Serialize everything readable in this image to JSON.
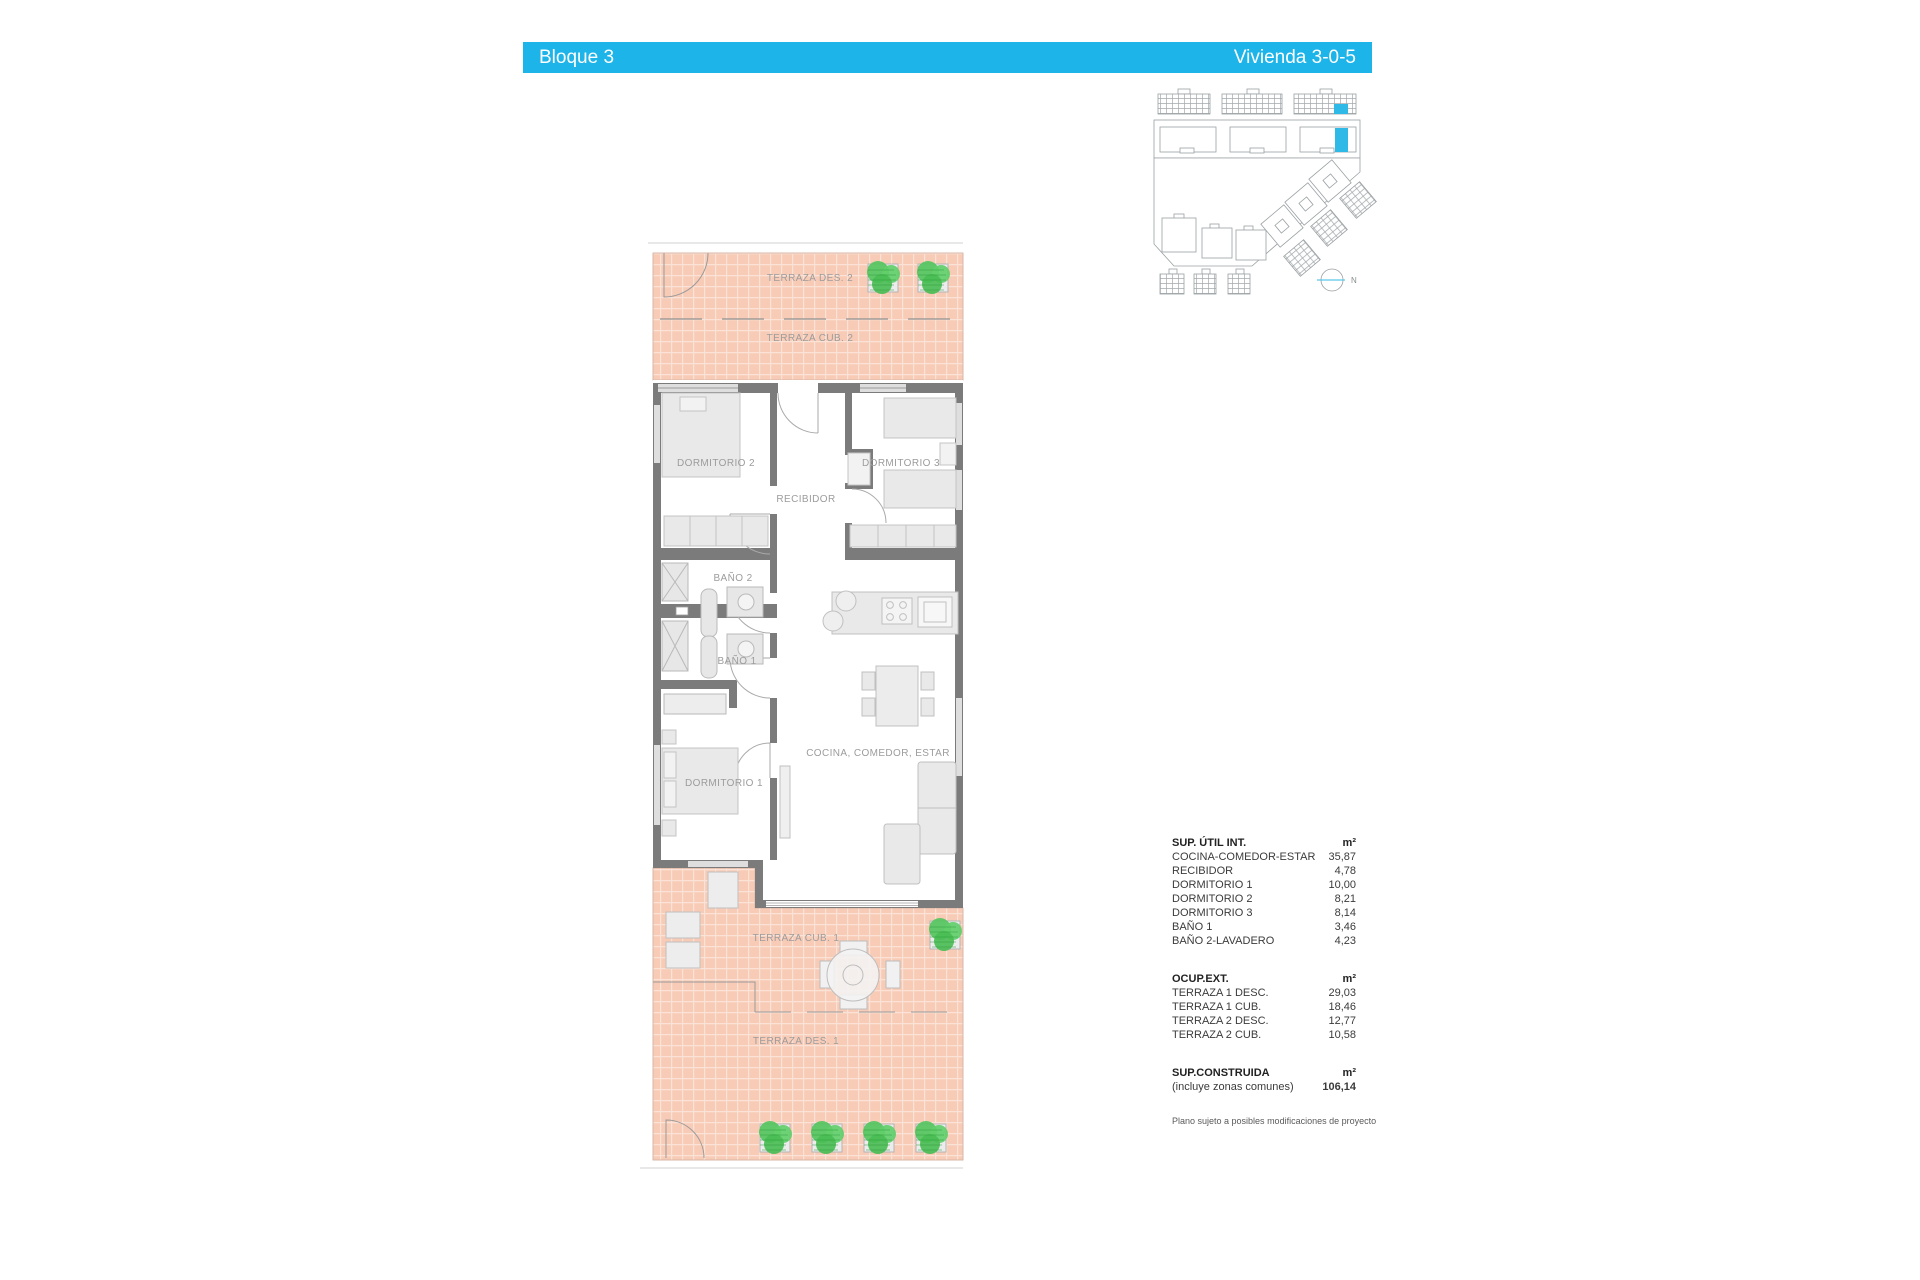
{
  "header": {
    "block_title": "Bloque 3",
    "unit_title": "Vivienda 3-0-5",
    "accent_color": "#1cb4e9"
  },
  "site_plan": {
    "north_label": "N",
    "highlight_color": "#2fb9e6"
  },
  "floor_plan": {
    "labels": {
      "terraza_des_2": "TERRAZA DES. 2",
      "terraza_cub_2": "TERRAZA CUB. 2",
      "dormitorio_2": "DORMITORIO 2",
      "dormitorio_3": "DORMITORIO 3",
      "recibidor": "RECIBIDOR",
      "bano_2": "BAÑO 2",
      "bano_1": "BAÑO 1",
      "dormitorio_1": "DORMITORIO 1",
      "cocina": "COCINA, COMEDOR, ESTAR",
      "terraza_cub_1": "TERRAZA CUB. 1",
      "terraza_des_1": "TERRAZA DES. 1"
    },
    "colors": {
      "terrace_fill": "#f8cbb7",
      "wall": "#7b7b7b",
      "furniture": "#e9e9e9",
      "plant_green": "#55c45e"
    }
  },
  "tables": {
    "util": {
      "title": "SUP. ÚTIL INT.",
      "unit": "m²",
      "rows": [
        {
          "label": "COCINA-COMEDOR-ESTAR",
          "value": "35,87"
        },
        {
          "label": "RECIBIDOR",
          "value": "4,78"
        },
        {
          "label": "DORMITORIO 1",
          "value": "10,00"
        },
        {
          "label": "DORMITORIO 2",
          "value": "8,21"
        },
        {
          "label": "DORMITORIO 3",
          "value": "8,14"
        },
        {
          "label": "BAÑO 1",
          "value": "3,46"
        },
        {
          "label": "BAÑO 2-LAVADERO",
          "value": "4,23"
        }
      ]
    },
    "ext": {
      "title": "OCUP.EXT.",
      "unit": "m²",
      "rows": [
        {
          "label": "TERRAZA 1 DESC.",
          "value": "29,03"
        },
        {
          "label": "TERRAZA 1 CUB.",
          "value": "18,46"
        },
        {
          "label": "TERRAZA 2 DESC.",
          "value": "12,77"
        },
        {
          "label": "TERRAZA 2 CUB.",
          "value": "10,58"
        }
      ]
    },
    "construida": {
      "title": "SUP.CONSTRUIDA",
      "unit": "m²",
      "note": "(incluye zonas comunes)",
      "value": "106,14"
    }
  },
  "footnote": "Plano sujeto a posibles modificaciones de proyecto"
}
